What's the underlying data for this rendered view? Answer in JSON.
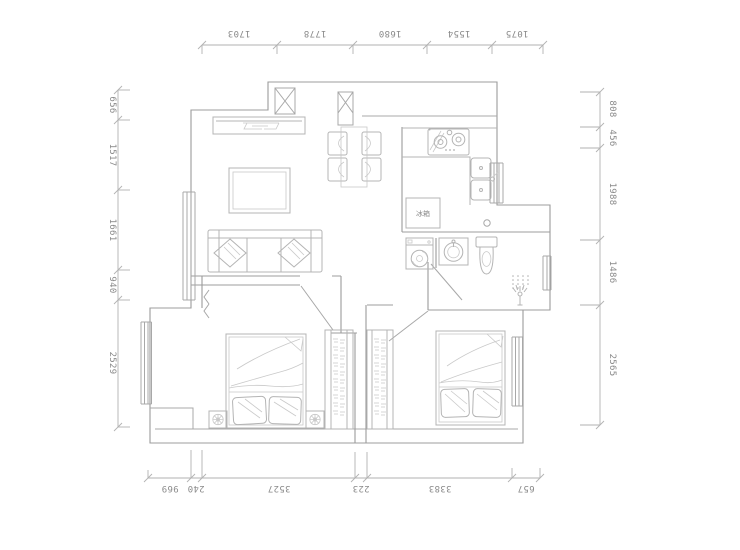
{
  "page": {
    "background": "#ffffff"
  },
  "plan": {
    "type": "apartment-floor-plan",
    "colors": {
      "wall_line": "#9c9c9c",
      "furniture_line": "#b4b4b4",
      "dimension_line": "#b2b2b2",
      "dimension_text": "#8a8a8a"
    },
    "labels": {
      "fridge": "冰箱"
    },
    "dimensions_mm": {
      "top": [
        "1703",
        "1778",
        "1680",
        "1554",
        "1075"
      ],
      "left": [
        "656",
        "1517",
        "1661",
        "940",
        "2529"
      ],
      "right": [
        "808",
        "456",
        "1988",
        "1486",
        "2565"
      ],
      "bottom": [
        "969",
        "240",
        "3527",
        "223",
        "3383",
        "657"
      ]
    },
    "fixtures": [
      "tv-cabinet",
      "coffee-table",
      "sofa",
      "structural-column",
      "dining-table",
      "dining-chairs",
      "gas-stove",
      "kitchen-sink",
      "refrigerator",
      "washing-machine",
      "wash-basin",
      "toilet",
      "shower",
      "window",
      "door",
      "double-bed",
      "wardrobe",
      "nightstand",
      "plant"
    ]
  }
}
